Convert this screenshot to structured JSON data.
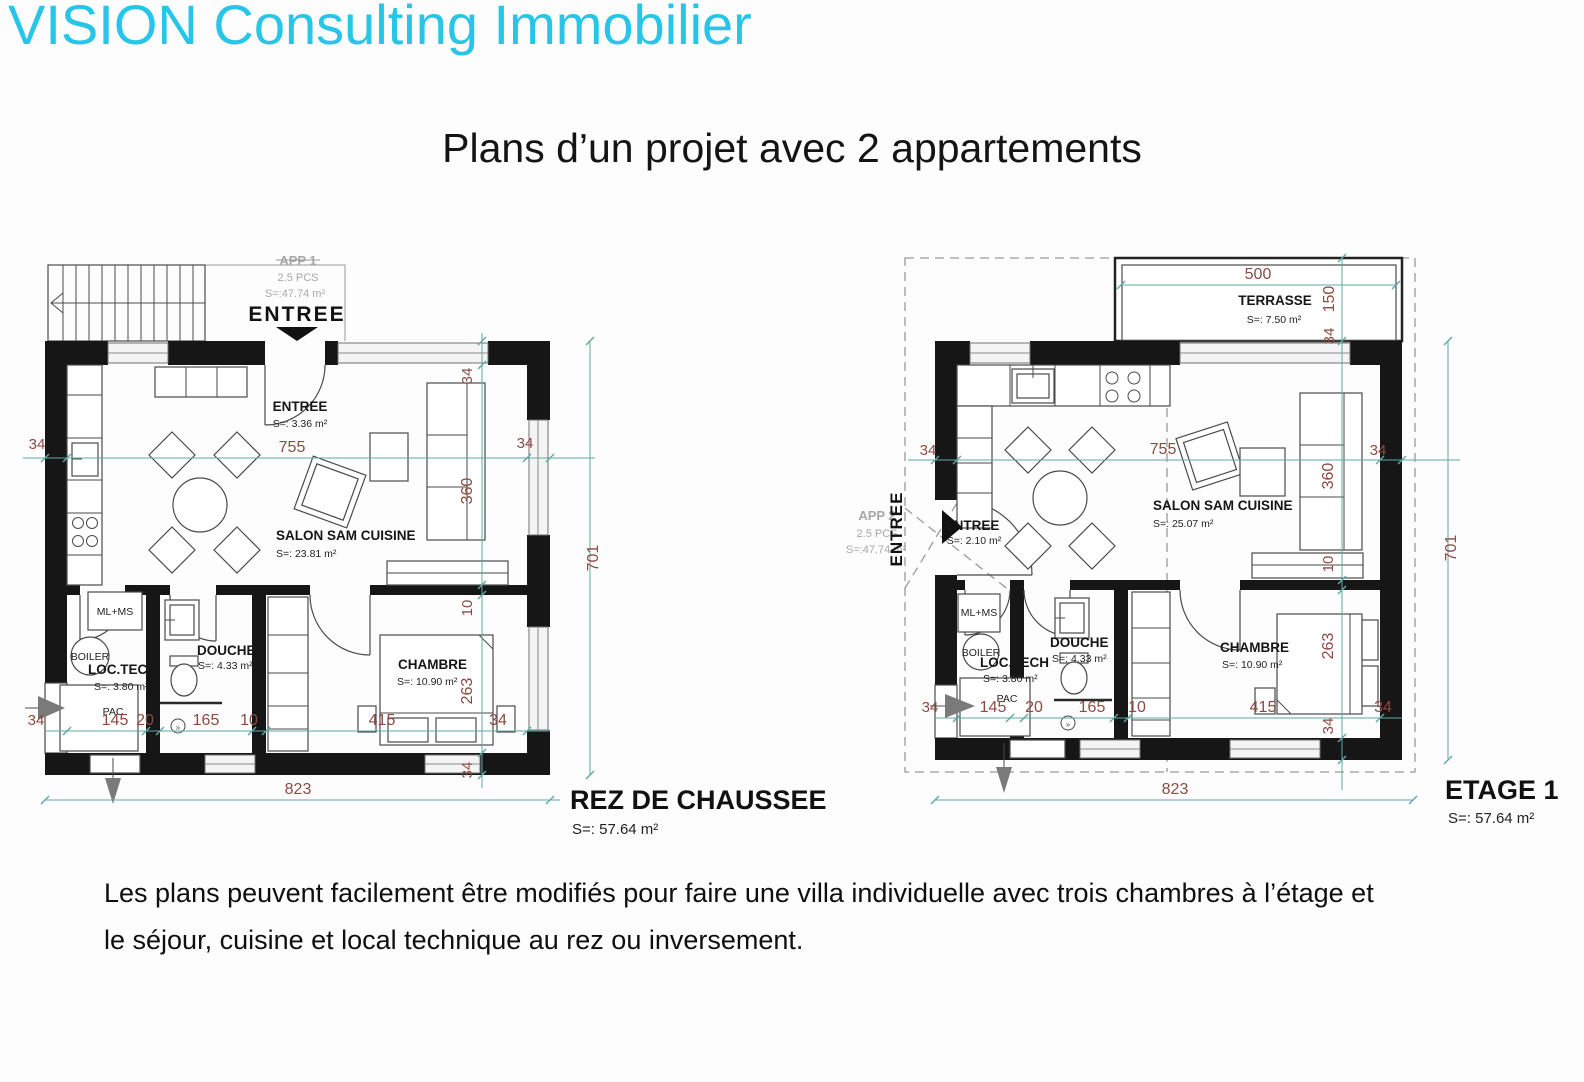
{
  "header": {
    "brand": "VISION Consulting Immobilier",
    "title": "Plans d’un projet avec 2 appartements"
  },
  "colors": {
    "brand_cyan": "#27c5e8",
    "dim_line_teal": "#5fa8a5",
    "dim_text_red": "#8c4b42",
    "wall_black": "#161616",
    "gray_text": "#a7a7a7"
  },
  "plan_left": {
    "title": "REZ DE CHAUSSEE",
    "title_surface": "S=: 57.64 m²",
    "app": {
      "name": "APP 1",
      "pcs": "2.5 PCS",
      "surface": "S=:47.74 m²"
    },
    "entree_sign": "ENTREE",
    "rooms": {
      "entree": {
        "name": "ENTREE",
        "surface": "S=: 3.36 m²"
      },
      "salon": {
        "name": "SALON SAM CUISINE",
        "surface": "S=: 23.81 m²"
      },
      "douche": {
        "name": "DOUCHE",
        "surface": "S=: 4.33 m²"
      },
      "chambre": {
        "name": "CHAMBRE",
        "surface": "S=: 10.90 m²"
      },
      "loctech": {
        "name": "LOC.TECH",
        "surface": "S=: 3.80 m²"
      },
      "pac": "PAC",
      "mlms": "ML+MS",
      "boiler": "BOILER"
    },
    "dims": {
      "wall_left": "34",
      "inner_width": "755",
      "wall_right": "34",
      "v34top": "34",
      "v360": "360",
      "v10": "10",
      "v263": "263",
      "v34bottom": "34",
      "height": "701",
      "total_width": "823",
      "row34left": "34",
      "seg145": "145",
      "seg20": "20",
      "seg165": "165",
      "seg10": "10",
      "seg415": "415",
      "seg34": "34"
    }
  },
  "plan_right": {
    "title": "ETAGE 1",
    "title_surface": "S=: 57.64 m²",
    "app": {
      "name": "APP 2",
      "pcs": "2.5 PCS",
      "surface": "S=:47.74 m²"
    },
    "entree_sign": "ENTREE",
    "terrasse": {
      "name": "TERRASSE",
      "surface": "S=: 7.50 m²"
    },
    "rooms": {
      "entree": {
        "name": "ENTREE",
        "surface": "S=: 2.10 m²"
      },
      "salon": {
        "name": "SALON SAM CUISINE",
        "surface": "S=: 25.07 m²"
      },
      "douche": {
        "name": "DOUCHE",
        "surface": "S=: 4.33 m²"
      },
      "chambre": {
        "name": "CHAMBRE",
        "surface": "S=: 10.90 m²"
      },
      "loctech": {
        "name": "LOC.TECH",
        "surface": "S=: 3.80 m²"
      },
      "pac": "PAC",
      "mlms": "ML+MS",
      "boiler": "BOILER"
    },
    "dims": {
      "terrasse_width": "500",
      "t150": "150",
      "t34": "34",
      "wall_left": "34",
      "inner_width": "755",
      "wall_right": "34",
      "v360": "360",
      "v10": "10",
      "v263": "263",
      "v34bottom": "34",
      "height": "701",
      "total_width": "823",
      "row34left": "34",
      "seg145": "145",
      "seg20": "20",
      "seg165": "165",
      "seg10": "10",
      "seg415": "415",
      "seg34": "34"
    }
  },
  "footer": {
    "line1": "Les plans peuvent facilement être modifiés pour faire une villa individuelle avec trois chambres à l’étage et",
    "line2": "le séjour, cuisine et local technique au rez ou inversement."
  }
}
